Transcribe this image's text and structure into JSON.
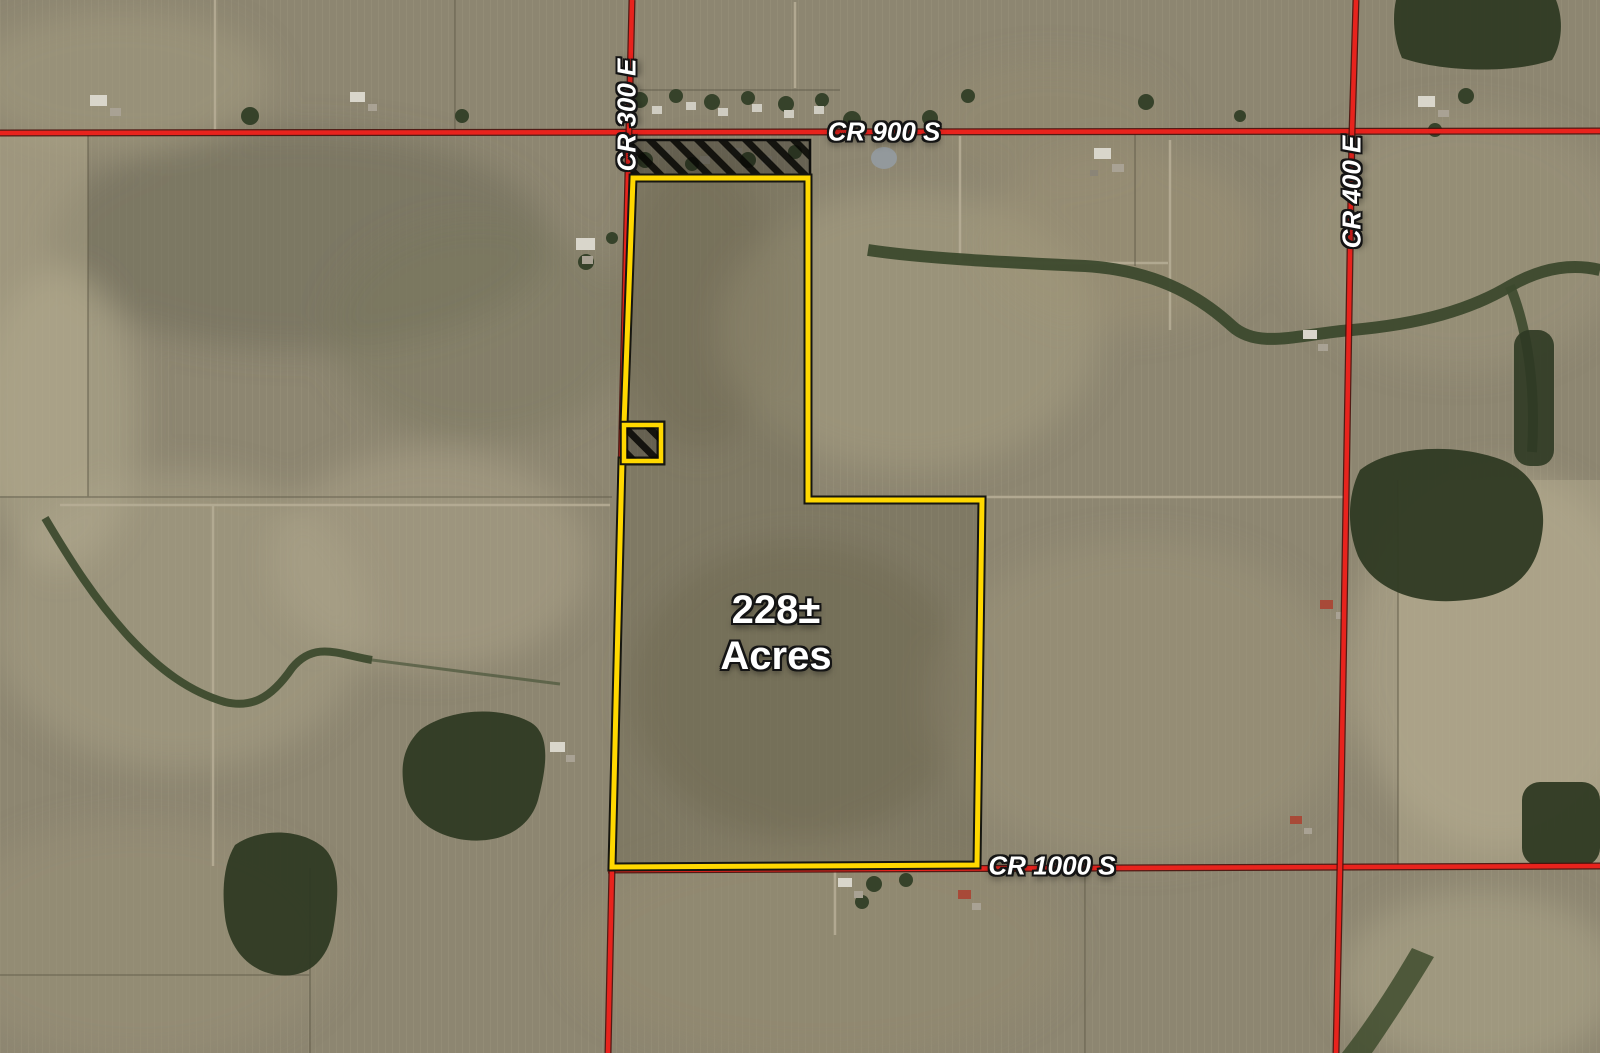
{
  "map": {
    "type": "aerial-parcel-map",
    "parcel": {
      "acreage_value": "228±",
      "acreage_unit": "Acres",
      "boundary_color": "#FFD800",
      "boundary_points": "633,178 808,178 808,500 982,500 977,865 612,867 622,461 661,461 661,425 624,425"
    },
    "exclusions": {
      "north_strip_points": "632,140 810,140 810,177 632,177",
      "small_square_points": "624,425 661,425 661,461 624,461",
      "hatch_color": "#111111"
    },
    "roads": {
      "color": "#E8231D",
      "cr300e": {
        "label": "CR 300 E",
        "points": "632,0 622,430 612,868 608,1053"
      },
      "cr900s": {
        "label": "CR 900 S",
        "points": "0,133 1600,131"
      },
      "cr400e": {
        "label": "CR 400 E",
        "points": "1356,0 1352,133 1340,867 1336,1053"
      },
      "cr1000s": {
        "label": "CR 1000 S",
        "points": "608,870 1600,866"
      }
    },
    "label_color": "#FFFFFF"
  }
}
